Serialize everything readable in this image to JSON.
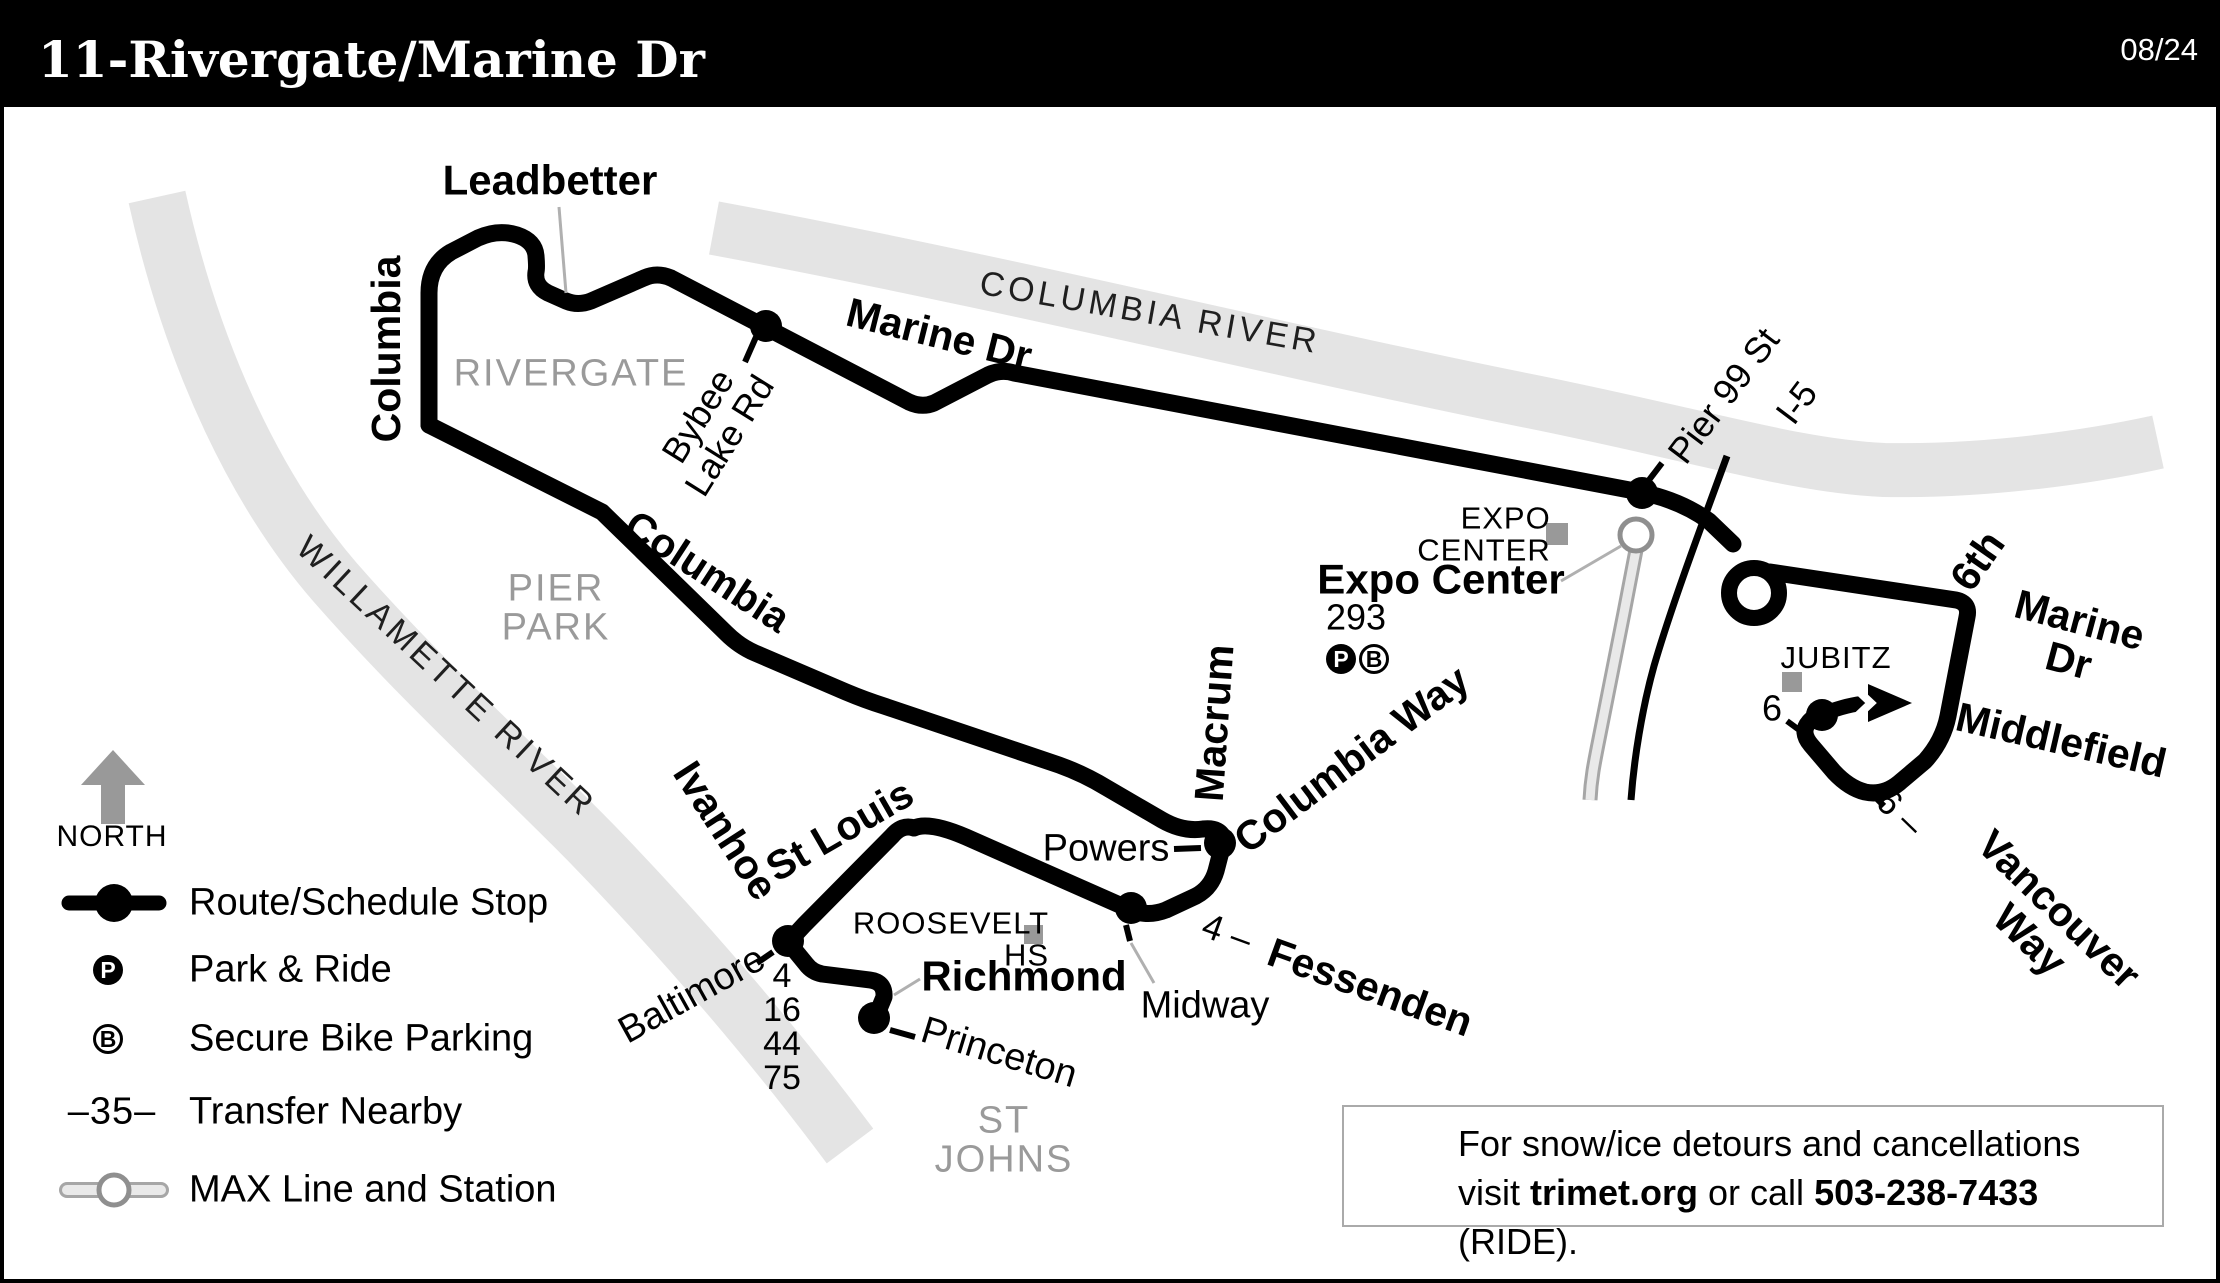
{
  "header": {
    "title": "11-Rivergate/Marine Dr",
    "date": "08/24"
  },
  "legend": {
    "north": "NORTH",
    "transfer_symbol": "–35–",
    "park_glyph": "P",
    "bike_glyph": "B",
    "items": [
      {
        "id": "route-stop",
        "label": "Route/Schedule Stop"
      },
      {
        "id": "park-ride",
        "label": "Park & Ride"
      },
      {
        "id": "bike-parking",
        "label": "Secure Bike Parking"
      },
      {
        "id": "transfer-nearby",
        "label": "Transfer Nearby"
      },
      {
        "id": "max-line",
        "label": "MAX Line and Station"
      }
    ]
  },
  "notice": {
    "line1": "For snow/ice detours and cancellations",
    "visit_prefix": "visit ",
    "site": "trimet.org",
    "mid": " or call ",
    "phone": "503-238-7433",
    "suffix": " (RIDE)."
  },
  "map": {
    "icons": {
      "park_glyph": "P",
      "bike_glyph": "B"
    },
    "labels": {
      "leadbetter": "Leadbetter",
      "marine_dr_top": "Marine Dr",
      "columbia_vert": "Columbia",
      "rivergate": "RIVERGATE",
      "bybee": "Bybee\nLake Rd",
      "columbia_river": "COLUMBIA  RIVER",
      "willamette_river": "WILLAMETTE  RIVER",
      "pier_park": "PIER\nPARK",
      "columbia_diag": "Columbia",
      "pier99": "Pier 99 St",
      "i5": "I-5",
      "expo_center_lm": "EXPO\nCENTER",
      "expo_center_stop": "Expo Center",
      "num293": "293",
      "jubitz": "JUBITZ",
      "sixth": "6th",
      "marine_dr_right": "Marine Dr",
      "middlefield": "Middlefield",
      "vancouver": "Vancouver Way",
      "six_vanc": "6 –",
      "six_jubitz": "6",
      "macrum": "Macrum",
      "columbia_way": "Columbia Way",
      "powers": "Powers",
      "four_fess": "4 –",
      "fessenden": "Fessenden",
      "midway": "Midway",
      "st_louis": "St Louis",
      "ivanhoe": "Ivanhoe",
      "baltimore": "Baltimore",
      "richmond": "Richmond",
      "princeton": "Princeton",
      "roosevelt": "ROOSEVELT\nHS",
      "st_johns": "ST\nJOHNS",
      "transfer_column": "4\n16\n44\n75"
    }
  }
}
